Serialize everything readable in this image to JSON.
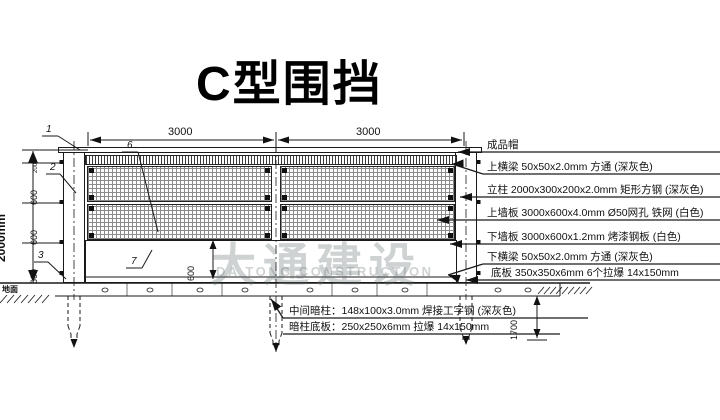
{
  "title": "C型围挡",
  "watermark": {
    "cn": "大通建设",
    "en": "DA TONG CONSTRUCTION"
  },
  "dims": {
    "total_height": "2000mm",
    "seg_200": "200",
    "seg_600_1": "600",
    "seg_600_2": "600",
    "seg_600_3": "600",
    "bay_1": "3000",
    "bay_2": "3000",
    "panel_600": "600",
    "depth_1700": "1700",
    "ground": "地面"
  },
  "callouts": {
    "c1": "1",
    "c2": "2",
    "c3": "3",
    "c6": "6",
    "c7": "7"
  },
  "right_labels": [
    "成品帽",
    "上横梁 50x50x2.0mm 方通 (深灰色)",
    "立柱 2000x300x200x2.0mm 矩形方钢 (深灰色)",
    "上墙板 3000x600x4.0mm Ø50网孔 铁网 (白色)",
    "下墙板 3000x600x1.2mm 烤漆钢板 (白色)",
    "下横梁 50x50x2.0mm 方通 (深灰色)",
    "底板 350x350x6mm 6个拉爆 14x150mm"
  ],
  "bottom_labels": [
    "中间暗柱：148x100x3.0mm 焊接工字钢 (深灰色)",
    "暗柱底板：250x250x6mm  拉爆 14x150mm"
  ]
}
